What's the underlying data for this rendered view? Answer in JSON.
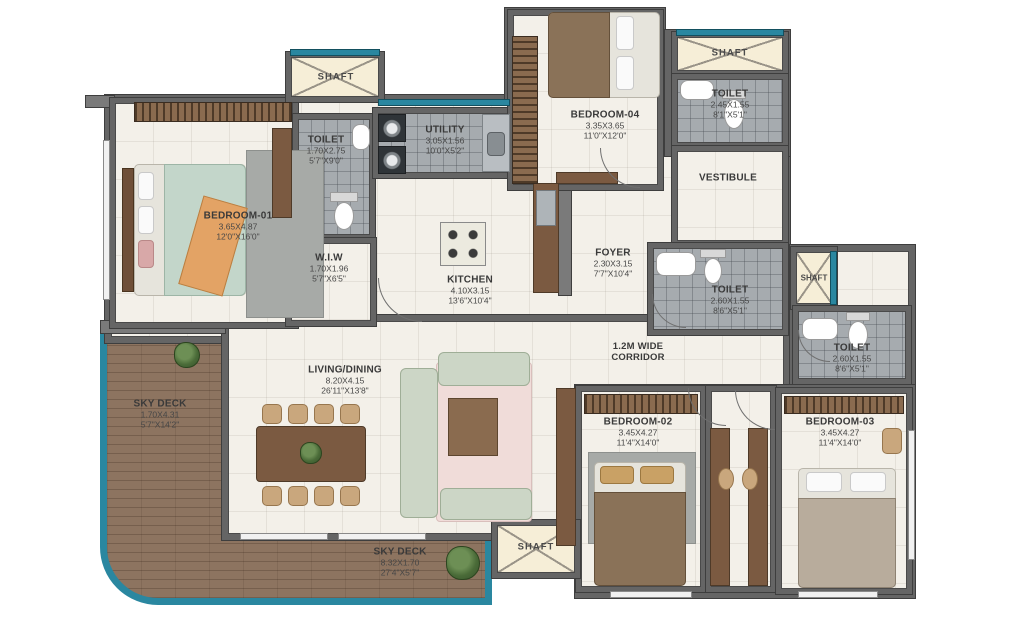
{
  "plan": {
    "shaft_label": "SHAFT",
    "rooms": {
      "bedroom01": {
        "name": "BEDROOM-01",
        "metric": "3.65X4.87",
        "imperial": "12'0\"X16'0\""
      },
      "toilet1": {
        "name": "TOILET",
        "metric": "1.70X2.75",
        "imperial": "5'7\"X9'0\""
      },
      "utility": {
        "name": "UTILITY",
        "metric": "3.05X1.56",
        "imperial": "10'0\"X5'2\""
      },
      "wiw": {
        "name": "W.I.W",
        "metric": "1.70X1.96",
        "imperial": "5'7\"X6'5\""
      },
      "kitchen": {
        "name": "KITCHEN",
        "metric": "4.10X3.15",
        "imperial": "13'6\"X10'4\""
      },
      "foyer": {
        "name": "FOYER",
        "metric": "2.30X3.15",
        "imperial": "7'7\"X10'4\""
      },
      "bedroom04": {
        "name": "BEDROOM-04",
        "metric": "3.35X3.65",
        "imperial": "11'0\"X12'0\""
      },
      "toilet2": {
        "name": "TOILET",
        "metric": "2.45X1.55",
        "imperial": "8'1\"X5'1\""
      },
      "vestibule": {
        "name": "VESTIBULE"
      },
      "toilet3": {
        "name": "TOILET",
        "metric": "2.60X1.55",
        "imperial": "8'6\"X5'1\""
      },
      "toilet4": {
        "name": "TOILET",
        "metric": "2.60X1.55",
        "imperial": "8'6\"X5'1\""
      },
      "corridor": {
        "line1": "1.2M WIDE",
        "line2": "CORRIDOR"
      },
      "living": {
        "name": "LIVING/DINING",
        "metric": "8.20X4.15",
        "imperial": "26'11\"X13'8\""
      },
      "skydeckLeft": {
        "name": "SKY DECK",
        "metric": "1.70X4.31",
        "imperial": "5'7\"X14'2\""
      },
      "skydeckBottom": {
        "name": "SKY DECK",
        "metric": "8.32X1.70",
        "imperial": "27'4\"X5'7\""
      },
      "bedroom02": {
        "name": "BEDROOM-02",
        "metric": "3.45X4.27",
        "imperial": "11'4\"X14'0\""
      },
      "bedroom03": {
        "name": "BEDROOM-03",
        "metric": "3.45X4.27",
        "imperial": "11'4\"X14'0\""
      }
    },
    "colors": {
      "wall": "#656565",
      "deck_border": "#2a87a0",
      "deck_wood": "#8d7460",
      "toilet_tile": "#a6abaf",
      "shaft_fill": "#f6eed7",
      "window_glass": "#2a87a0",
      "floor": "#f3f0e9"
    }
  }
}
